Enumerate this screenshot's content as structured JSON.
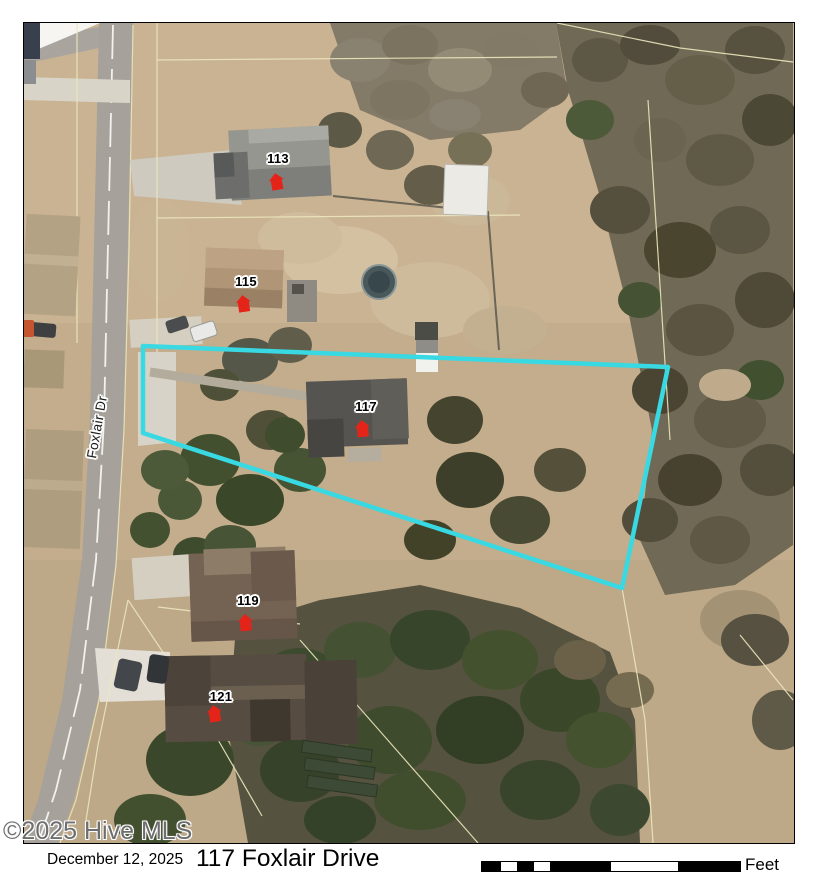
{
  "watermark": "©2025 Hive MLS",
  "footer": {
    "date_label": "December 12, 2025",
    "title_label": "117 Foxlair Drive",
    "scale_unit_label": "Feet"
  },
  "map": {
    "road_label": "Foxlair Dr",
    "house_labels": [
      "113",
      "115",
      "117",
      "119",
      "121"
    ],
    "colors": {
      "property_boundary": "#38d9e2",
      "house_marker": "#e52419",
      "parcel_line": "#ece7bd",
      "road": "#a6a29b"
    }
  }
}
